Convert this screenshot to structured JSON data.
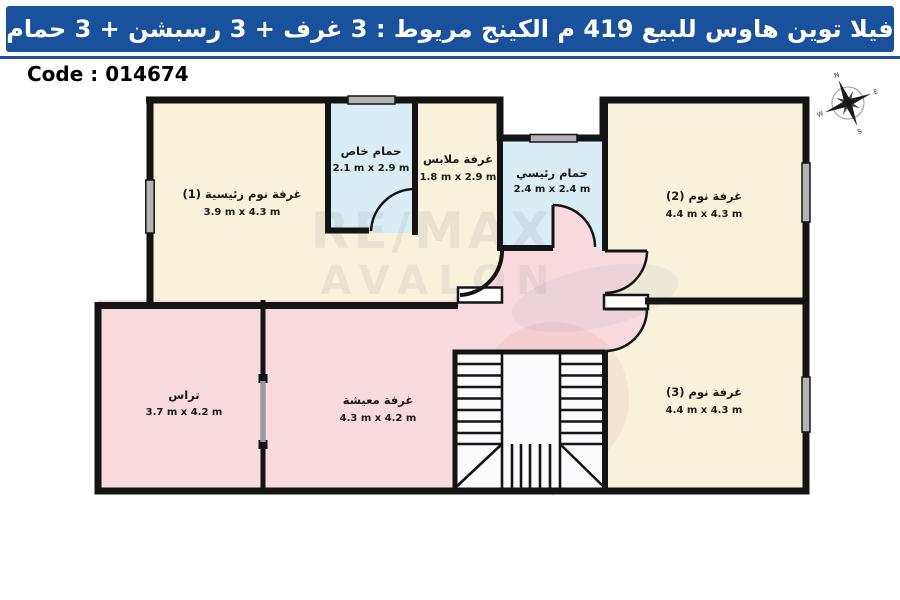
{
  "header": {
    "title": "فيلا توين هاوس للبيع 419 م الكينج مريوط :  3 غرف + 3 رسبشن + 3 حمام",
    "bar_color": "#1a519c",
    "text_color": "#ffffff"
  },
  "code": {
    "label": "Code : 014674"
  },
  "compass": {
    "n": "N",
    "e": "E",
    "s": "S",
    "w": "W"
  },
  "watermark": {
    "line1": "RE/MAX",
    "line2": "AVALON"
  },
  "colors": {
    "wall": "#141414",
    "room_cream": "#f7f2d9",
    "room_blue": "#d9edf5",
    "room_pink": "#f8d9de",
    "window_gray": "#b3b3b3"
  },
  "rooms": [
    {
      "id": "master-bedroom",
      "name": "غرفة نوم رئيسية (1)",
      "dims": "3.9 m x 4.3 m",
      "color": "#f7f2d9"
    },
    {
      "id": "private-bathroom",
      "name": "حمام خاص",
      "dims": "2.1 m x 2.9 m",
      "color": "#d9edf5"
    },
    {
      "id": "dressing-room",
      "name": "غرفة ملابس",
      "dims": "1.8 m x 2.9 m",
      "color": "#f7f2d9"
    },
    {
      "id": "main-bathroom",
      "name": "حمام رئيسي",
      "dims": "2.4 m x 2.4 m",
      "color": "#d9edf5"
    },
    {
      "id": "bedroom-2",
      "name": "غرفة نوم (2)",
      "dims": "4.4 m x 4.3 m",
      "color": "#f7f2d9"
    },
    {
      "id": "bedroom-3",
      "name": "غرفة نوم (3)",
      "dims": "4.4 m x 4.3 m",
      "color": "#f7f2d9"
    },
    {
      "id": "living-room",
      "name": "غرفة معيشة",
      "dims": "4.3 m x 4.2 m",
      "color": "#f8d9de"
    },
    {
      "id": "terrace",
      "name": "تراس",
      "dims": "3.7 m x 4.2 m",
      "color": "#f8d9de"
    }
  ]
}
